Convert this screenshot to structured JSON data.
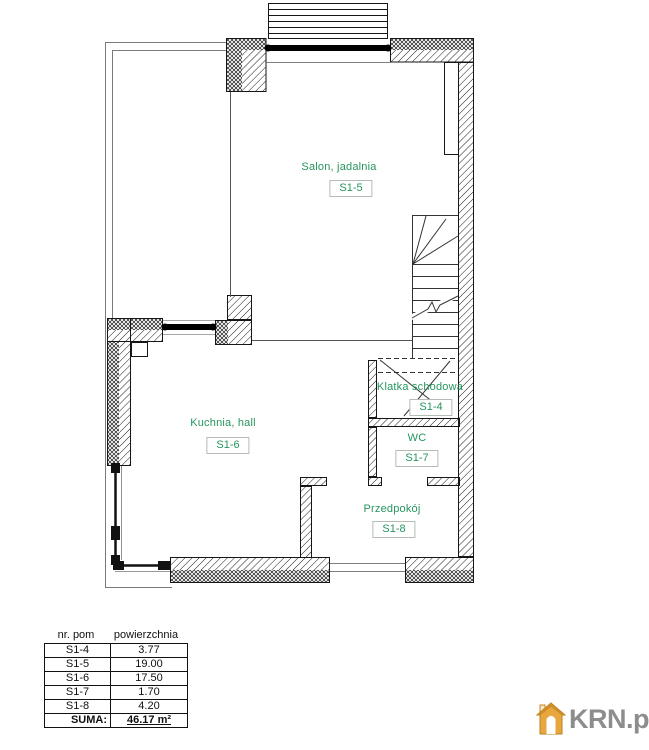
{
  "plan": {
    "rooms": [
      {
        "id": "salon",
        "name": "Salon, jadalnia",
        "code": "S1-5"
      },
      {
        "id": "kuchnia",
        "name": "Kuchnia,  hall",
        "code": "S1-6"
      },
      {
        "id": "klatka",
        "name": "Klatka schodowa",
        "code": "S1-4"
      },
      {
        "id": "wc",
        "name": "WC",
        "code": "S1-7"
      },
      {
        "id": "przedpokoj",
        "name": "Przedpokój",
        "code": "S1-8"
      }
    ]
  },
  "table": {
    "headers": {
      "col1": "nr. pom",
      "col2": "powierzchnia"
    },
    "rows": [
      {
        "nr": "S1-4",
        "area": "3.77"
      },
      {
        "nr": "S1-5",
        "area": "19.00"
      },
      {
        "nr": "S1-6",
        "area": "17.50"
      },
      {
        "nr": "S1-7",
        "area": "1.70"
      },
      {
        "nr": "S1-8",
        "area": "4.20"
      }
    ],
    "total_label": "SUMA:",
    "total_value": "46.17 m²"
  },
  "watermark": {
    "text": "KRN.pl",
    "icon": "house-icon"
  },
  "colors": {
    "room_label_color": "#26955f",
    "logo_text_color": "#8d8d8d",
    "logo_house_color": "#e8a63f"
  }
}
